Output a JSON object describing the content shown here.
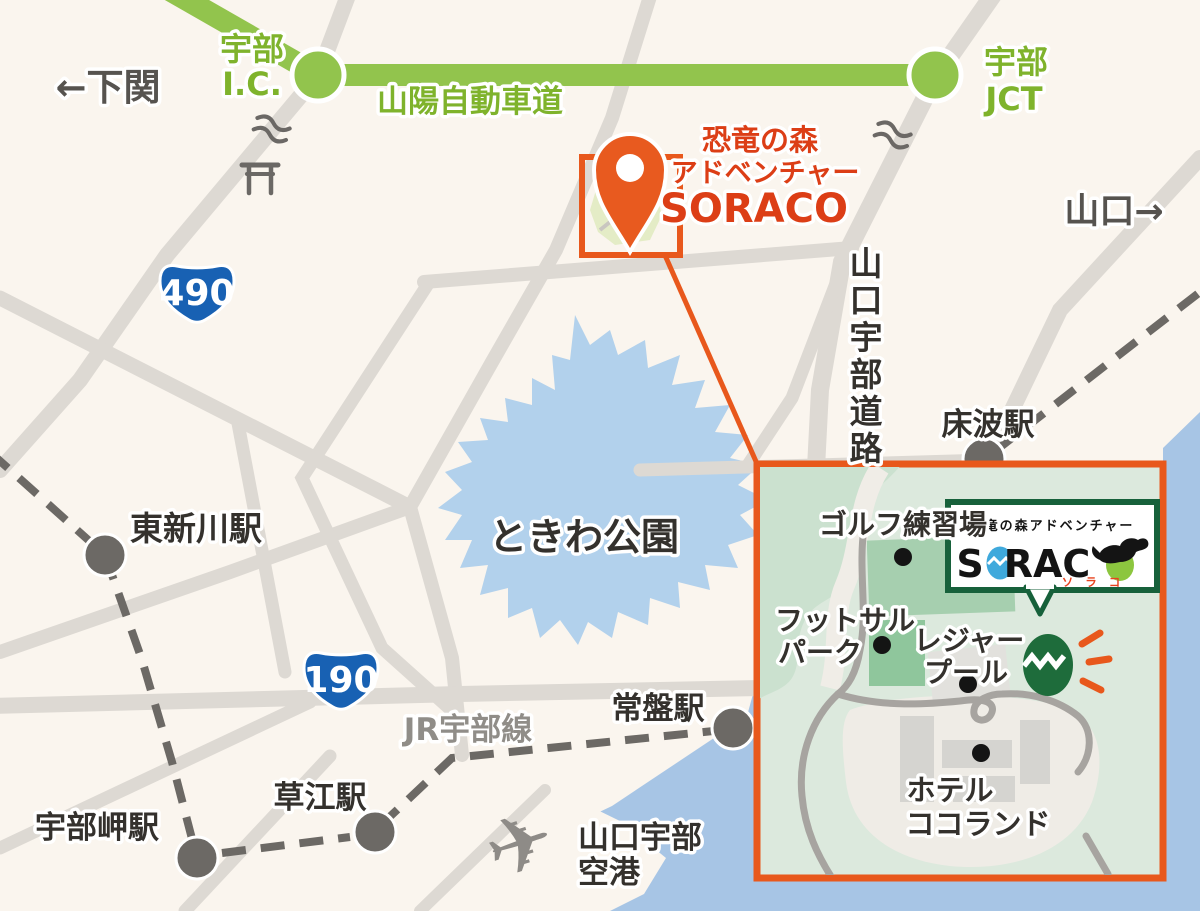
{
  "map": {
    "colors": {
      "background": "#FAF5EE",
      "road_gray": "#DDD9D3",
      "rail_dark_gray": "#6C6965",
      "highway_green": "#92C44D",
      "highway_text_green": "#7FB32C",
      "route_shield_blue": "#1861B3",
      "destination_red": "#DC3E16",
      "accent_orange": "#E8581C",
      "lake_blue": "#B2D1EC",
      "sea_blue": "#A7C5E5",
      "inset_bg_green": "#DCE9DD",
      "logo_green_border": "#17613B",
      "destination_egg_green": "#1E6C3B",
      "logo_egg_blue": "#3FA9DC",
      "logo_egg_green": "#8CC63F"
    },
    "directions": {
      "west": "←下関",
      "east": "山口→"
    },
    "expressway": {
      "name": "山陽自動車道",
      "ic_line1": "宇部",
      "ic_line2": "I.C.",
      "jct_line1": "宇部",
      "jct_line2": "JCT"
    },
    "destination": {
      "line1": "恐竜の森",
      "line2": "アドベンチャー",
      "line3": "SORACO"
    },
    "route_shields": [
      {
        "number": "490"
      },
      {
        "number": "190"
      }
    ],
    "park_name": "ときわ公園",
    "road_vertical": {
      "name": "山口宇部道路",
      "chars": [
        "山",
        "口",
        "宇",
        "部",
        "道",
        "路"
      ]
    },
    "rail_line": "JR宇部線",
    "stations": [
      {
        "id": "tokonami",
        "name": "床波駅"
      },
      {
        "id": "higashi-shinkawa",
        "name": "東新川駅"
      },
      {
        "id": "tokiwa",
        "name": "常盤駅"
      },
      {
        "id": "kusae",
        "name": "草江駅"
      },
      {
        "id": "ube-misaki",
        "name": "宇部岬駅"
      }
    ],
    "airport": {
      "line1": "山口宇部",
      "line2": "空港"
    },
    "inset": {
      "golf_label": "ゴルフ練習場",
      "futsal_label_line1": "フットサル",
      "futsal_label_line2": "パーク",
      "pool_label_line1": "レジャー",
      "pool_label_line2": "プール",
      "hotel_label_line1": "ホテル",
      "hotel_label_line2": "ココランド",
      "logo": {
        "tagline": "恐竜の森アドベンチャー",
        "word_s": "S",
        "word_rac": "RAC",
        "katakana": "ソ ラ コ"
      }
    }
  }
}
